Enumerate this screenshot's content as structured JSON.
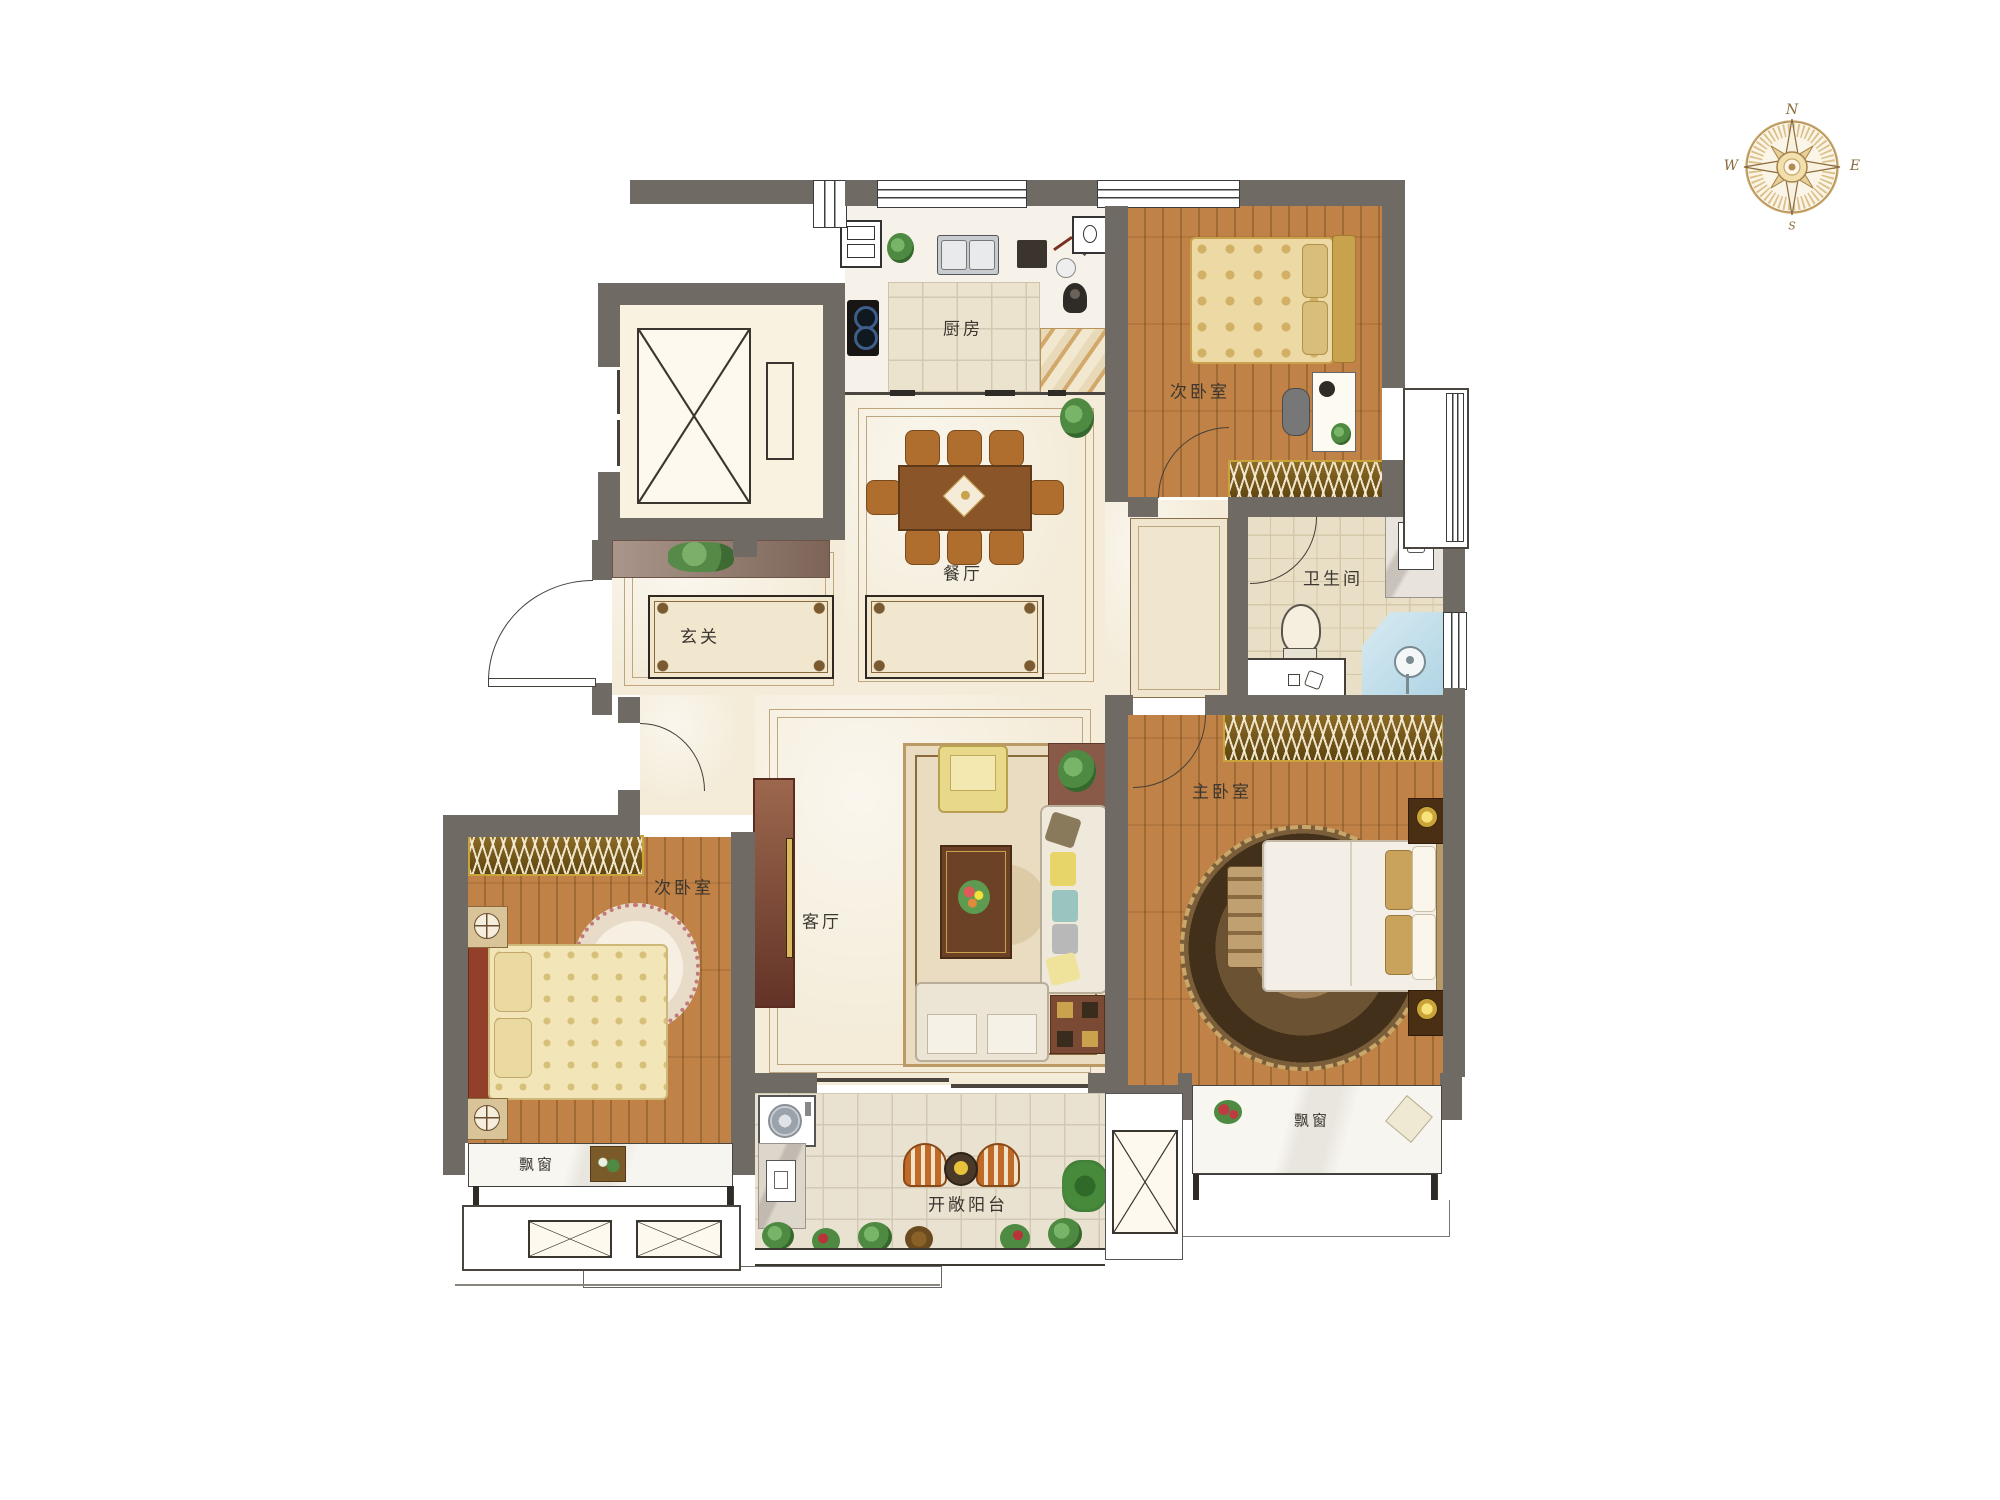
{
  "compass": {
    "north": "N",
    "south": "S",
    "east": "E",
    "west": "W"
  },
  "rooms": {
    "kitchen": {
      "label": "厨房"
    },
    "bedroom_top": {
      "label": "次卧室"
    },
    "bathroom": {
      "label": "卫生间"
    },
    "dining": {
      "label": "餐厅"
    },
    "entry": {
      "label": "玄关"
    },
    "living": {
      "label": "客厅"
    },
    "master_bedroom": {
      "label": "主卧室"
    },
    "bedroom_left": {
      "label": "次卧室"
    },
    "balcony": {
      "label": "开敞阳台"
    },
    "bay_window_left": {
      "label": "飘窗"
    },
    "bay_window_master": {
      "label": "飘窗"
    }
  },
  "colors": {
    "wall": "#6f6b64",
    "wood_floor": "#c08246",
    "marble_floor": "#f4ecd9",
    "tile_floor": "#eae2d1",
    "wardrobe_gold": "#c9a43a",
    "shower_blue": "#c3dde9",
    "compass_gold": "#b08a4e"
  }
}
